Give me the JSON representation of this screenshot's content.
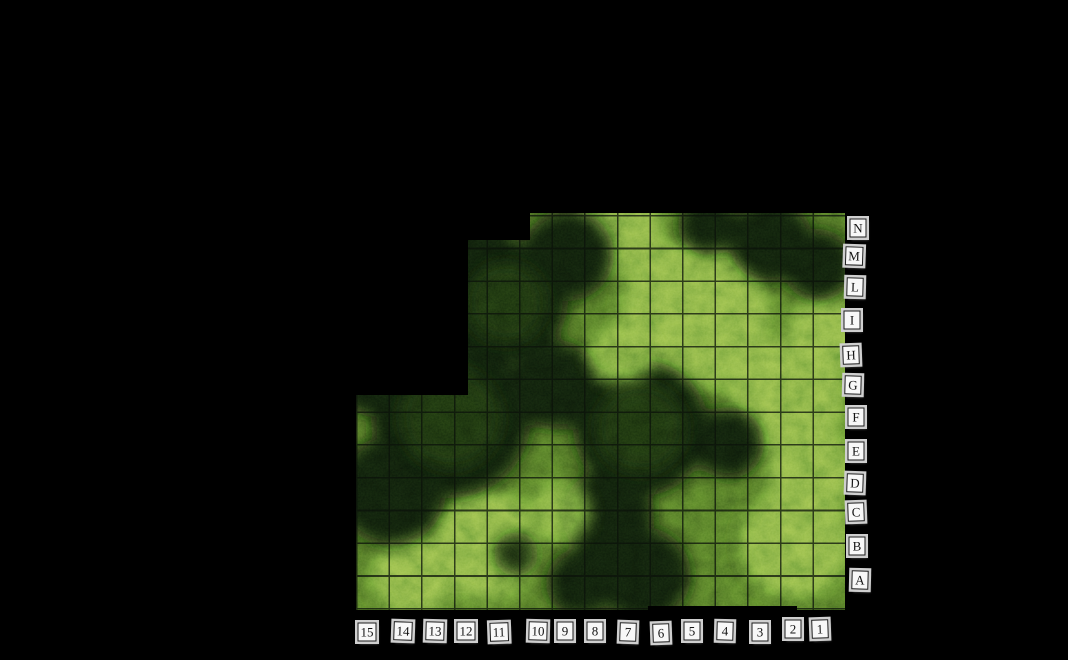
{
  "scene": {
    "description": "Top-down forest battle map on black canvas with grid coordinate tokens",
    "terrain": "forest-and-grass"
  },
  "map": {
    "grid": {
      "rows_count": 12,
      "columns_count": 15,
      "cell_size_px": 33
    },
    "rows": [
      {
        "label": "N",
        "x": 858,
        "y": 228
      },
      {
        "label": "M",
        "x": 854,
        "y": 256
      },
      {
        "label": "L",
        "x": 855,
        "y": 287
      },
      {
        "label": "I",
        "x": 852,
        "y": 320
      },
      {
        "label": "H",
        "x": 851,
        "y": 355
      },
      {
        "label": "G",
        "x": 853,
        "y": 385
      },
      {
        "label": "F",
        "x": 856,
        "y": 417
      },
      {
        "label": "E",
        "x": 856,
        "y": 451
      },
      {
        "label": "D",
        "x": 855,
        "y": 483
      },
      {
        "label": "C",
        "x": 856,
        "y": 512
      },
      {
        "label": "B",
        "x": 857,
        "y": 546
      },
      {
        "label": "A",
        "x": 860,
        "y": 580
      }
    ],
    "columns": [
      {
        "label": "15",
        "x": 367,
        "y": 632
      },
      {
        "label": "14",
        "x": 403,
        "y": 631
      },
      {
        "label": "13",
        "x": 435,
        "y": 631
      },
      {
        "label": "12",
        "x": 466,
        "y": 631
      },
      {
        "label": "11",
        "x": 499,
        "y": 632
      },
      {
        "label": "10",
        "x": 538,
        "y": 631
      },
      {
        "label": "9",
        "x": 565,
        "y": 631
      },
      {
        "label": "8",
        "x": 595,
        "y": 631
      },
      {
        "label": "7",
        "x": 628,
        "y": 632
      },
      {
        "label": "6",
        "x": 661,
        "y": 633
      },
      {
        "label": "5",
        "x": 692,
        "y": 631
      },
      {
        "label": "4",
        "x": 725,
        "y": 631
      },
      {
        "label": "3",
        "x": 760,
        "y": 632
      },
      {
        "label": "2",
        "x": 793,
        "y": 629
      },
      {
        "label": "1",
        "x": 820,
        "y": 629
      }
    ]
  },
  "colors": {
    "background": "#000000",
    "grass_base": "#4d682c",
    "grass_light": "#7fa04d",
    "forest_dark": "#0d170b",
    "forest_mid": "#243417",
    "grid_line": "#0b120a",
    "token_bg": "#f8f8f8",
    "token_border": "#1c1c1c",
    "token_ring": "#cfcfcf",
    "token_text": "#141414"
  }
}
